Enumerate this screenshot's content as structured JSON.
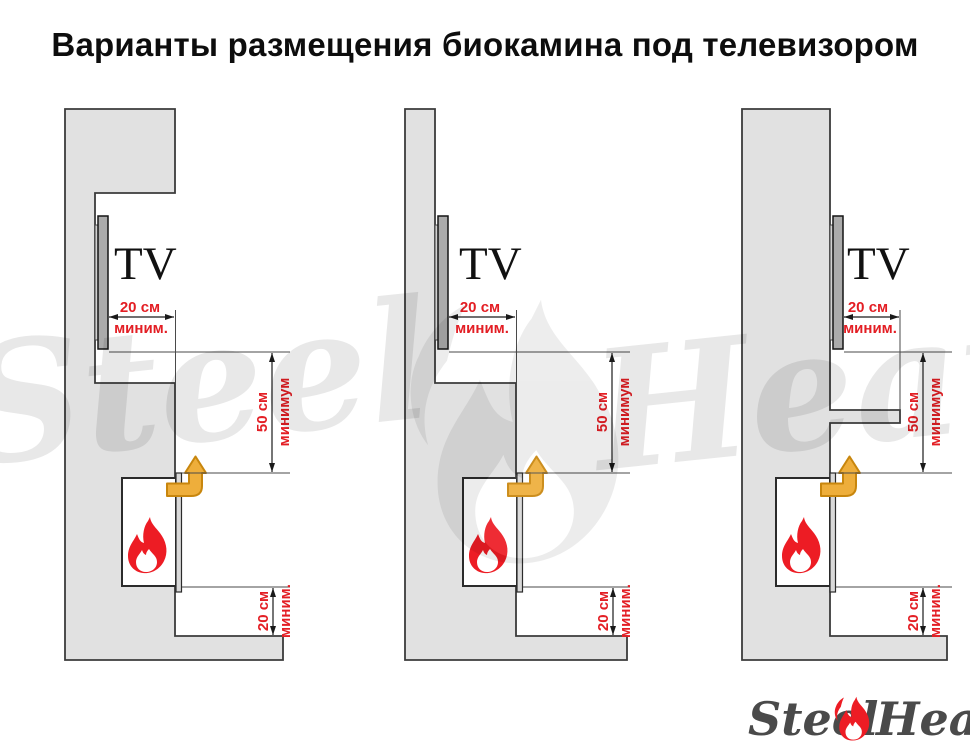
{
  "title": "Варианты размещения биокамина под телевизором",
  "colors": {
    "wall_fill": "#e1e1e1",
    "outline": "#3b3b3b",
    "dimension_red": "#e31e24",
    "flame_red": "#ed1c24",
    "arrow_fill": "#eeae3b",
    "arrow_stroke": "#c8860d",
    "logo_gray": "#4a4a4a"
  },
  "watermark": {
    "word1": "Steel",
    "word2": "Heat"
  },
  "logo": {
    "word1": "Steel",
    "word2": "Heat"
  },
  "diagrams": [
    {
      "tv_label": "TV",
      "top_clearance": {
        "value": "20 см",
        "qualifier": "миним."
      },
      "vertical_clearance": {
        "value": "50 см",
        "qualifier": "минимум"
      },
      "bottom_clearance": {
        "value": "20 см",
        "qualifier": "миним."
      }
    },
    {
      "tv_label": "TV",
      "top_clearance": {
        "value": "20 см",
        "qualifier": "миним."
      },
      "vertical_clearance": {
        "value": "50 см",
        "qualifier": "минимум"
      },
      "bottom_clearance": {
        "value": "20 см",
        "qualifier": "миним."
      }
    },
    {
      "tv_label": "TV",
      "top_clearance": {
        "value": "20 см",
        "qualifier": "миним."
      },
      "vertical_clearance": {
        "value": "50 см",
        "qualifier": "минимум"
      },
      "bottom_clearance": {
        "value": "20 см",
        "qualifier": "миним."
      }
    }
  ]
}
